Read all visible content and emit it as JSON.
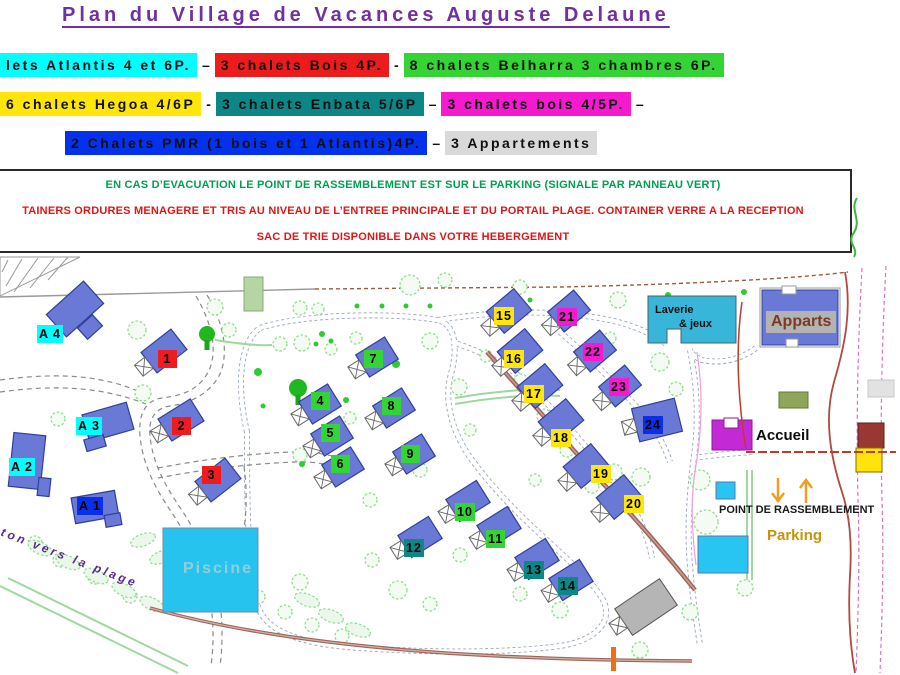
{
  "title": "Plan du Village de Vacances Auguste Delaune",
  "title_color": "#7030a0",
  "legend": {
    "rows": [
      {
        "items": [
          {
            "text": "lets Atlantis 4 et 6P.",
            "bg": "#00ffff",
            "name": "legend-atlantis"
          },
          {
            "text": "–",
            "name": "legend-dash"
          },
          {
            "text": "3 chalets Bois 4P.",
            "bg": "#ed1c1c",
            "name": "legend-bois-4p"
          },
          {
            "text": "-",
            "name": "legend-dash"
          },
          {
            "text": "8 chalets Belharra 3 chambres 6P.",
            "bg": "#35d435",
            "name": "legend-belharra"
          }
        ]
      },
      {
        "items": [
          {
            "text": "6 chalets Hegoa 4/6P",
            "bg": "#ffe60a",
            "name": "legend-hegoa"
          },
          {
            "text": "-",
            "name": "legend-dash"
          },
          {
            "text": "3 chalets Enbata 5/6P",
            "bg": "#0e8686",
            "name": "legend-enbata"
          },
          {
            "text": "–",
            "name": "legend-dash"
          },
          {
            "text": "3 chalets bois 4/5P.",
            "bg": "#f519cf",
            "name": "legend-bois-45p"
          },
          {
            "text": "–",
            "name": "legend-dash"
          }
        ]
      },
      {
        "items": [
          {
            "text": "2 Chalets PMR (1 bois et 1 Atlantis)4P.",
            "bg": "#0431ec",
            "name": "legend-pmr"
          },
          {
            "text": "–",
            "name": "legend-dash"
          },
          {
            "text": "3 Appartements",
            "bg": "#d9d9d9",
            "name": "legend-appartements"
          }
        ]
      }
    ]
  },
  "notice": {
    "line1": "EN CAS D’EVACUATION LE POINT DE RASSEMBLEMENT EST SUR LE PARKING (SIGNALE PAR PANNEAU VERT)",
    "line1_color": "#00a050",
    "line2": "TAINERS ORDURES MENAGERE ET TRIS AU NIVEAU DE L’ENTREE PRINCIPALE ET DU PORTAIL PLAGE. CONTAINER VERRE A LA RECEPTION",
    "line3": "SAC DE TRIE DISPONIBLE DANS VOTRE HEBERGEMENT",
    "lines23_color": "#e01515"
  },
  "map": {
    "labels": {
      "piscine": "Piscine",
      "laverie_line1": "Laverie",
      "laverie_line2": "& jeux",
      "apparts": "Apparts",
      "accueil": "Accueil",
      "point_rassemblement": "POINT DE RASSEMBLEMENT",
      "parking": "Parking",
      "plage_path": "ton vers la plage"
    },
    "marker_colors": {
      "red": "#ee1c1c",
      "green": "#35d435",
      "teal": "#0e8686",
      "yellow": "#ffe60a",
      "magenta": "#f519cf",
      "blue": "#0a2fe8",
      "cyan": "#00ffff"
    },
    "markers": [
      {
        "label": "A 4",
        "color": "cyan",
        "x": 37,
        "y": 325
      },
      {
        "label": "A 3",
        "color": "cyan",
        "x": 76,
        "y": 417
      },
      {
        "label": "A 2",
        "color": "cyan",
        "x": 9,
        "y": 458
      },
      {
        "label": "A 1",
        "color": "blue",
        "x": 77,
        "y": 497
      },
      {
        "label": "1",
        "color": "red",
        "x": 158,
        "y": 350
      },
      {
        "label": "2",
        "color": "red",
        "x": 172,
        "y": 417
      },
      {
        "label": "3",
        "color": "red",
        "x": 202,
        "y": 466
      },
      {
        "label": "4",
        "color": "green",
        "x": 311,
        "y": 392
      },
      {
        "label": "5",
        "color": "green",
        "x": 321,
        "y": 424
      },
      {
        "label": "6",
        "color": "green",
        "x": 331,
        "y": 455
      },
      {
        "label": "7",
        "color": "green",
        "x": 364,
        "y": 350
      },
      {
        "label": "8",
        "color": "green",
        "x": 382,
        "y": 397
      },
      {
        "label": "9",
        "color": "green",
        "x": 401,
        "y": 445
      },
      {
        "label": "10",
        "color": "green",
        "x": 455,
        "y": 503
      },
      {
        "label": "11",
        "color": "green",
        "x": 486,
        "y": 530
      },
      {
        "label": "12",
        "color": "teal",
        "x": 404,
        "y": 539
      },
      {
        "label": "13",
        "color": "teal",
        "x": 524,
        "y": 561
      },
      {
        "label": "14",
        "color": "teal",
        "x": 558,
        "y": 577
      },
      {
        "label": "15",
        "color": "yellow",
        "x": 494,
        "y": 307
      },
      {
        "label": "16",
        "color": "yellow",
        "x": 504,
        "y": 350
      },
      {
        "label": "17",
        "color": "yellow",
        "x": 524,
        "y": 385
      },
      {
        "label": "18",
        "color": "yellow",
        "x": 551,
        "y": 429
      },
      {
        "label": "19",
        "color": "yellow",
        "x": 591,
        "y": 465
      },
      {
        "label": "20",
        "color": "yellow",
        "x": 624,
        "y": 495
      },
      {
        "label": "21",
        "color": "magenta",
        "x": 557,
        "y": 308
      },
      {
        "label": "22",
        "color": "magenta",
        "x": 583,
        "y": 343
      },
      {
        "label": "23",
        "color": "magenta",
        "x": 609,
        "y": 378
      },
      {
        "label": "24",
        "color": "blue",
        "x": 643,
        "y": 416
      }
    ]
  }
}
